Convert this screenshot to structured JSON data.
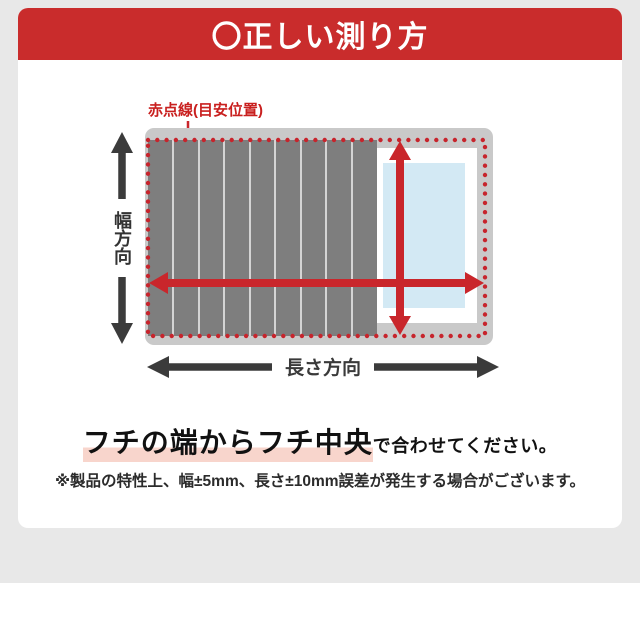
{
  "header": {
    "title": "〇正しい測り方"
  },
  "diagram": {
    "red_dotted_label": "赤点線(目安位置)",
    "width_direction_label": "幅方向",
    "length_direction_label": "長さ方向"
  },
  "message": {
    "highlighted_text": "フチの端からフチ中央",
    "rest_text": "で合わせてください。"
  },
  "footnote": "※製品の特性上、幅±5mm、長さ±10mm誤差が発生する場合がございます。",
  "colors": {
    "header_red": "#c92c2c",
    "accent_red": "#c9262b",
    "rim_gray": "#c9c9c9",
    "lid_gray": "#7e7e7e",
    "water_blue": "#d3e9f4",
    "arrow_black": "#3b3b3b",
    "highlight_pink": "#f8d5cc",
    "background_gray": "#e8e8e8"
  }
}
